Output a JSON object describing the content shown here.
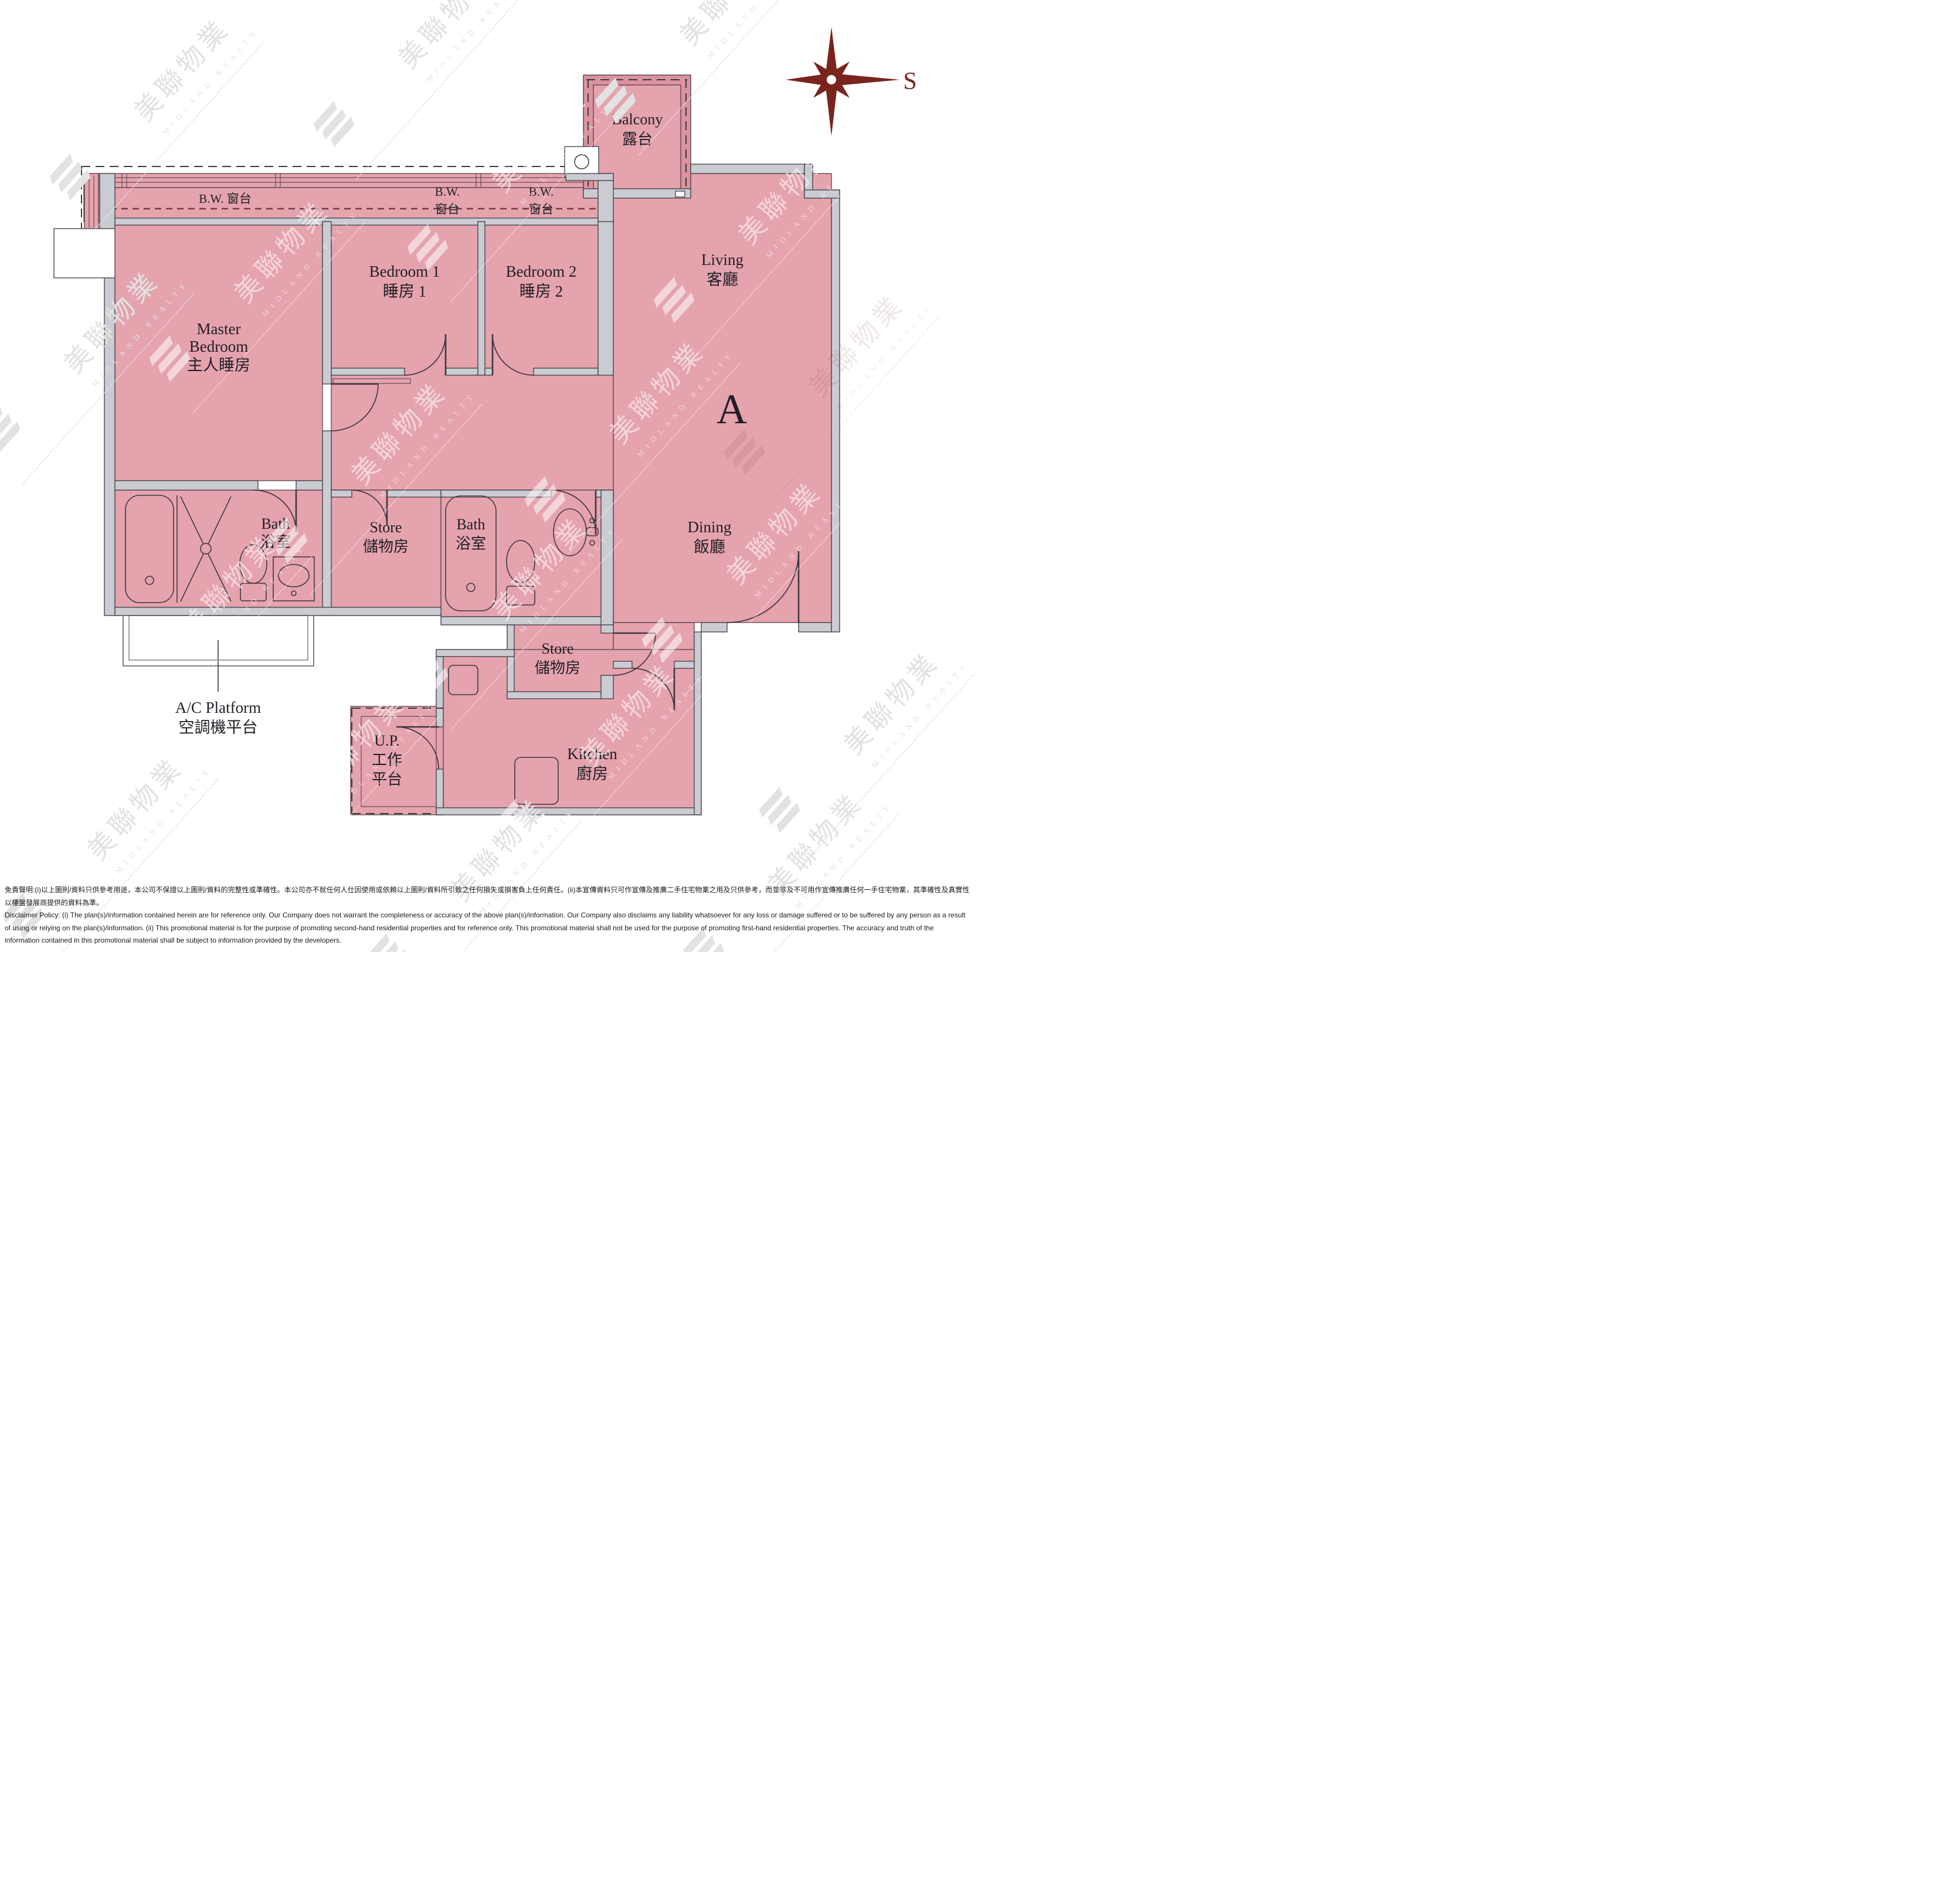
{
  "unit": {
    "label": "A"
  },
  "compass": {
    "label": "S"
  },
  "rooms": {
    "master": {
      "line1": "Master",
      "line2": "Bedroom",
      "zh": "主人睡房"
    },
    "bedroom1": {
      "en": "Bedroom 1",
      "zh": "睡房 1"
    },
    "bedroom2": {
      "en": "Bedroom 2",
      "zh": "睡房 2"
    },
    "living": {
      "en": "Living",
      "zh": "客廳"
    },
    "dining": {
      "en": "Dining",
      "zh": "飯廳"
    },
    "kitchen": {
      "en": "Kitchen",
      "zh": "廚房"
    },
    "bath": {
      "en": "Bath",
      "zh": "浴室"
    },
    "store": {
      "en": "Store",
      "zh": "儲物房"
    },
    "balcony": {
      "en": "Balcony",
      "zh": "露台"
    },
    "up": {
      "en": "U.P.",
      "zh1": "工作",
      "zh2": "平台"
    },
    "ac": {
      "en": "A/C Platform",
      "zh": "空調機平台"
    }
  },
  "bay_window": {
    "combined": "B.W. 窗台",
    "en": "B.W.",
    "zh": "窗台"
  },
  "watermark": {
    "zh": "美聯物業",
    "en": "MIDLAND REALTY"
  },
  "colors": {
    "room_pink": "#e5a3ae",
    "wall_gray": "#cbcbd2",
    "compass_maroon": "#79241d"
  },
  "disclaimer": {
    "zh": "免責聲明:(i)以上圖則/資料只供參考用途，本公司不保證以上圖則/資料的完整性或準確性。本公司亦不就任何人仕因使用或依賴以上圖則/資料所引致之任何損失或損害負上任何責任。(ii)本宣傳資料只可作宣傳及推廣二手住宅物業之用及只供參考，而並非及不可用作宣傳推廣任何一手住宅物業，其準確性及真實性以樓盤發展商提供的資料為準。",
    "en": "Disclaimer Policy: (i) The plan(s)/information contained herein are for reference only. Our Company does not warrant the completeness or accuracy of the above plan(s)/information. Our Company also disclaims any liability whatsoever for any loss or damage suffered or to be suffered by any person as a result of using or relying on the plan(s)/information. (ii) This promotional material is for the purpose of promoting second-hand residential properties and for reference only. This promotional material shall not be used for the purpose of promoting first-hand residential properties. The accuracy and truth of the information contained in this promotional material shall be subject to information provided by the developers."
  }
}
